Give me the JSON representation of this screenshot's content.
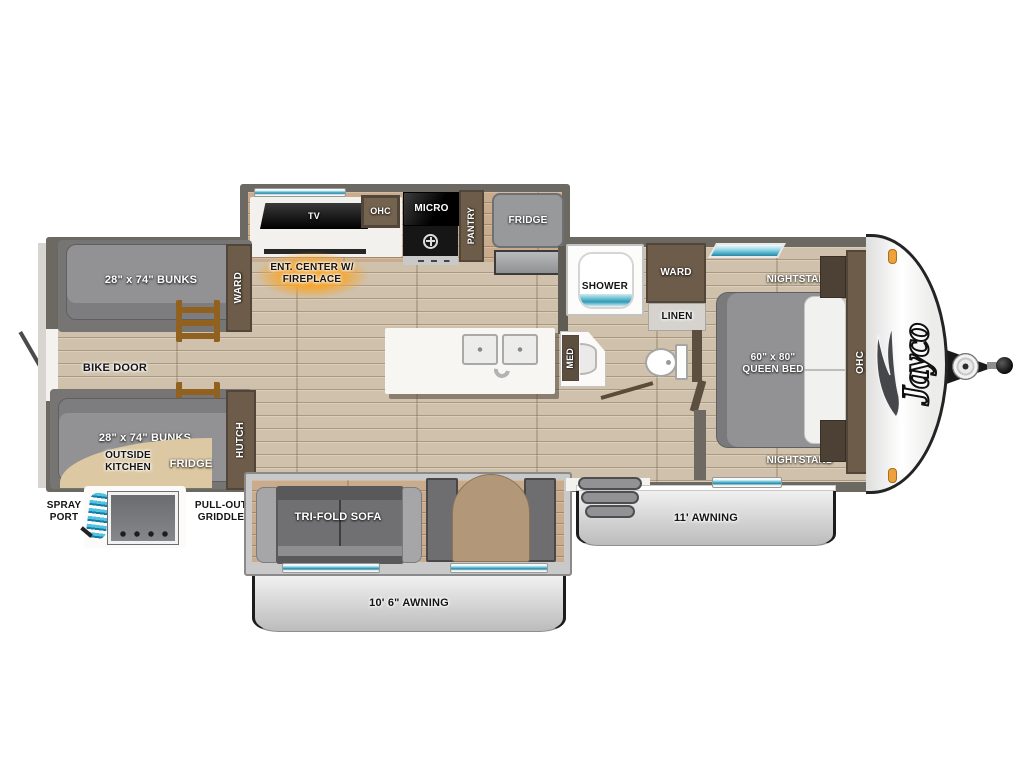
{
  "brand": {
    "logo": "Jayco"
  },
  "kitchen": {
    "tv": "TV",
    "ohc": "OHC",
    "micro": "MICRO",
    "pantry": "PANTRY",
    "fridge": "FRIDGE",
    "ent_center_line1": "ENT. CENTER W/",
    "ent_center_line2": "FIREPLACE"
  },
  "bunkhouse": {
    "ward": "WARD",
    "top_bunk": "28\" x 74\" BUNKS",
    "bottom_bunk": "28\" x 74\" BUNKS",
    "bike_door": "BIKE DOOR",
    "hutch": "HUTCH"
  },
  "outside_kitchen": {
    "name_line1": "OUTSIDE",
    "name_line2": "KITCHEN",
    "fridge": "FRIDGE",
    "spray_line1": "SPRAY",
    "spray_line2": "PORT",
    "griddle_line1": "PULL-OUT",
    "griddle_line2": "GRIDDLE"
  },
  "living": {
    "sofa": "TRI-FOLD SOFA"
  },
  "bathroom": {
    "shower": "SHOWER",
    "ward": "WARD",
    "linen": "LINEN",
    "med": "MED"
  },
  "bedroom": {
    "nightstand_top": "NIGHTSTAND",
    "nightstand_bottom": "NIGHTSTAND",
    "bed_line1": "60\" x 80\"",
    "bed_line2": "QUEEN BED",
    "ohc": "OHC"
  },
  "awnings": {
    "bottom": "10' 6\" AWNING",
    "right": "11' AWNING"
  },
  "colors": {
    "wall": "#6c6862",
    "floor": "#cfc1ab",
    "cabinet": "#6d5c49",
    "mattress": "#929294",
    "window_teal": "#1e89a6",
    "awning": "#d3d3d3",
    "accent_glow": "#f2a83b",
    "outside_kitchen_tan": "#dcc8a2",
    "marker_light": "#efa23a"
  }
}
